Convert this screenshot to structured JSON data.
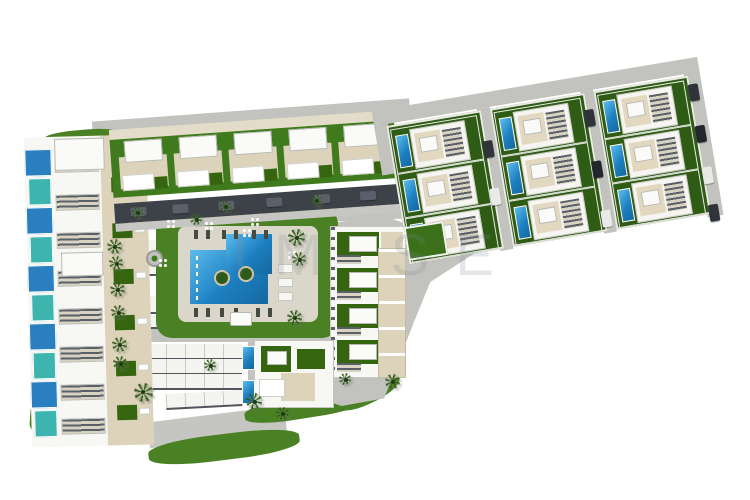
{
  "scene": {
    "title": "Aerial 3D master-plan render of a residential resort complex",
    "watermark": "IM SE",
    "colors": {
      "background": "#ffffff",
      "road": "#c2c2be",
      "road_light": "#cbcbc7",
      "shadow_dark": "#3d4248",
      "lawn": "#4a8124",
      "garden_dark": "#35660f",
      "villa_garden": "#2e5c14",
      "pool_blue": "#1d7fc0",
      "pool_light": "#5bbcec",
      "glass_blue": "#2a7fc0",
      "glass_teal": "#3db4ad",
      "beige": "#ddd3ba",
      "building_white": "#f7f7f4",
      "carport_white": "#f4f4f1"
    },
    "villa_band": {
      "clusters": 3,
      "villas_per_cluster": 3,
      "cluster_positions": [
        12,
        117,
        222
      ],
      "villa_row_y": [
        2,
        47,
        92
      ],
      "cars": [
        [
          104,
          48,
          "#2f343b"
        ],
        [
          103,
          96,
          "#e9e9e7"
        ],
        [
          209,
          34,
          "#2f343b"
        ],
        [
          208,
          86,
          "#23272d"
        ],
        [
          209,
          136,
          "#e9e9e7"
        ],
        [
          316,
          26,
          "#2f343b"
        ],
        [
          316,
          68,
          "#23272d"
        ],
        [
          316,
          110,
          "#e9e9e7"
        ],
        [
          316,
          148,
          "#2f343b"
        ]
      ]
    },
    "townhouse_row": {
      "units": 5,
      "unit_step": 55,
      "shadow_cars_x": [
        16,
        58,
        104,
        152,
        200,
        246
      ]
    },
    "left_block": {
      "panel_colors": [
        "#2a7fc0",
        "#3db4ad",
        "#2a7fc0",
        "#3db4ad",
        "#2a7fc0",
        "#3db4ad",
        "#2a7fc0",
        "#3db4ad",
        "#2a7fc0",
        "#3db4ad"
      ],
      "stripe_y": [
        20,
        58,
        96,
        134,
        172,
        210,
        248,
        282
      ],
      "garden_y": [
        42,
        88,
        134,
        180,
        226,
        270
      ]
    },
    "lawn": {
      "loungers_top": [
        [
          38,
          22
        ],
        [
          50,
          22
        ],
        [
          66,
          22
        ],
        [
          78,
          22
        ],
        [
          96,
          22
        ],
        [
          108,
          22
        ]
      ],
      "loungers_bottom": [
        [
          38,
          100
        ],
        [
          50,
          100
        ],
        [
          64,
          100
        ],
        [
          78,
          100
        ],
        [
          100,
          100
        ],
        [
          112,
          100
        ]
      ],
      "white_loungers": [
        [
          122,
          56
        ],
        [
          122,
          70
        ],
        [
          122,
          84
        ]
      ],
      "islands": [
        [
          58,
          62
        ],
        [
          82,
          58
        ]
      ]
    },
    "right_block": {
      "unit_rows_y": [
        2,
        38,
        74,
        110
      ]
    },
    "carport_strips": [
      [
        128,
        240,
        40,
        16,
        0
      ],
      [
        128,
        258,
        40,
        16,
        0
      ],
      [
        128,
        296,
        40,
        16,
        0
      ],
      [
        128,
        314,
        40,
        13,
        0
      ],
      [
        128,
        344,
        114,
        14,
        0
      ],
      [
        128,
        359,
        114,
        14,
        0
      ],
      [
        128,
        374,
        114,
        14,
        0
      ],
      [
        166,
        392,
        76,
        14,
        -3
      ]
    ],
    "roads": [
      {
        "x": 92,
        "y": 110,
        "w": 318,
        "h": 15,
        "r": -4.2
      },
      {
        "x": 104,
        "y": 208,
        "w": 300,
        "h": 17,
        "r": -2.5
      },
      {
        "x": 312,
        "y": 224,
        "w": 26,
        "h": 112,
        "r": 6
      },
      {
        "x": 112,
        "y": 326,
        "w": 226,
        "h": 16,
        "r": 0
      },
      {
        "x": 322,
        "y": 268,
        "w": 172,
        "h": 26,
        "r": -33
      },
      {
        "x": 102,
        "y": 236,
        "w": 26,
        "h": 188,
        "r": 1,
        "c": "#cbcbc7"
      },
      {
        "x": 148,
        "y": 414,
        "w": 138,
        "h": 26,
        "r": -7,
        "c": "#c5c5c1"
      },
      {
        "x": 248,
        "y": 336,
        "w": 96,
        "h": 66,
        "r": 0,
        "br": 8
      }
    ],
    "dark_edges": [
      {
        "x": 124,
        "y": 321,
        "w": 158,
        "h": 4
      }
    ],
    "green_patches": [
      {
        "x": 30,
        "y": 396,
        "w": 110,
        "h": 48,
        "r": 4,
        "br": "45% 55% 60% 40%"
      },
      {
        "x": 148,
        "y": 434,
        "w": 152,
        "h": 26,
        "r": -7,
        "br": "40%"
      },
      {
        "x": 244,
        "y": 396,
        "w": 124,
        "h": 22,
        "r": -9,
        "br": "40%"
      },
      {
        "x": 330,
        "y": 376,
        "w": 72,
        "h": 28,
        "r": -25,
        "br": "45%"
      },
      {
        "x": 44,
        "y": 130,
        "w": 74,
        "h": 14,
        "r": -5,
        "br": "40%"
      },
      {
        "x": 318,
        "y": 236,
        "w": 14,
        "h": 140,
        "r": 4,
        "br": "6px"
      }
    ],
    "palms": [
      [
        114,
        246,
        15
      ],
      [
        116,
        263,
        14
      ],
      [
        117,
        289,
        15
      ],
      [
        118,
        312,
        14
      ],
      [
        119,
        344,
        15
      ],
      [
        120,
        363,
        14
      ],
      [
        143,
        392,
        19
      ],
      [
        254,
        401,
        16
      ],
      [
        282,
        413,
        13
      ],
      [
        196,
        219,
        12
      ],
      [
        296,
        237,
        17
      ],
      [
        299,
        259,
        14
      ],
      [
        294,
        317,
        15
      ],
      [
        345,
        379,
        12
      ],
      [
        392,
        381,
        15
      ],
      [
        137,
        212,
        11
      ],
      [
        225,
        206,
        11
      ],
      [
        316,
        200,
        11
      ],
      [
        210,
        365,
        12
      ]
    ],
    "dot_clusters": [
      [
        166,
        219
      ],
      [
        204,
        221
      ],
      [
        250,
        217
      ],
      [
        158,
        258
      ],
      [
        287,
        250
      ],
      [
        242,
        228
      ]
    ],
    "small_pools": [
      [
        242,
        346
      ],
      [
        242,
        380
      ]
    ]
  }
}
